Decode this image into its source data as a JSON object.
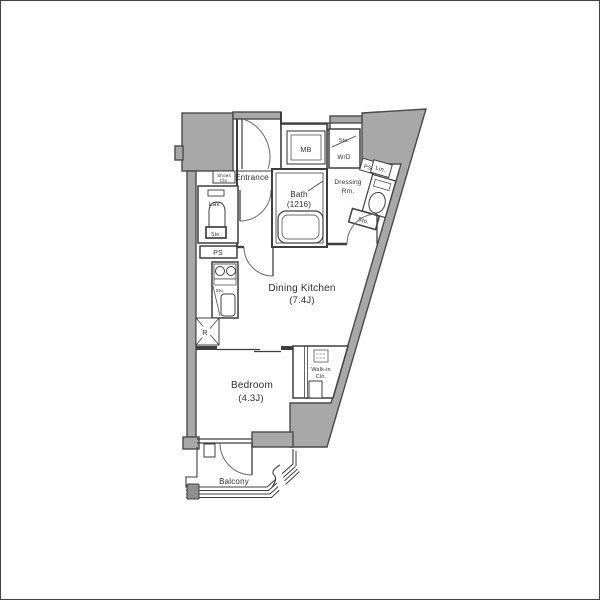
{
  "plan_title": "apartment-floor-plan",
  "rooms": {
    "dining_kitchen": {
      "name": "Dining Kitchen",
      "size": "(7.4J)"
    },
    "bedroom": {
      "name": "Bedroom",
      "size": "(4.3J)"
    },
    "bath": {
      "name": "Bath",
      "size": "(1216)"
    },
    "entrance": {
      "name": "Entrance"
    },
    "lavatory": {
      "name": "Lav."
    },
    "dressing_room": {
      "line1": "Dressing",
      "line2": "Rm."
    },
    "walk_in_closet": {
      "line1": "Walk-in",
      "line2": "Clo."
    },
    "shoes_closet": {
      "line1": "Shoes",
      "line2": "Clo."
    },
    "balcony": {
      "name": "Balcony"
    }
  },
  "fixtures": {
    "meter_box": "MB",
    "washer_dryer": "W/D",
    "pipe_space": "PS",
    "linen": "Lin.",
    "storage": "Sto.",
    "refrigerator": "R"
  },
  "colors": {
    "wall_fill": "#a8a8a8",
    "line": "#3f3f3f",
    "equipment": "#8f8f8f",
    "background": "#ffffff"
  }
}
